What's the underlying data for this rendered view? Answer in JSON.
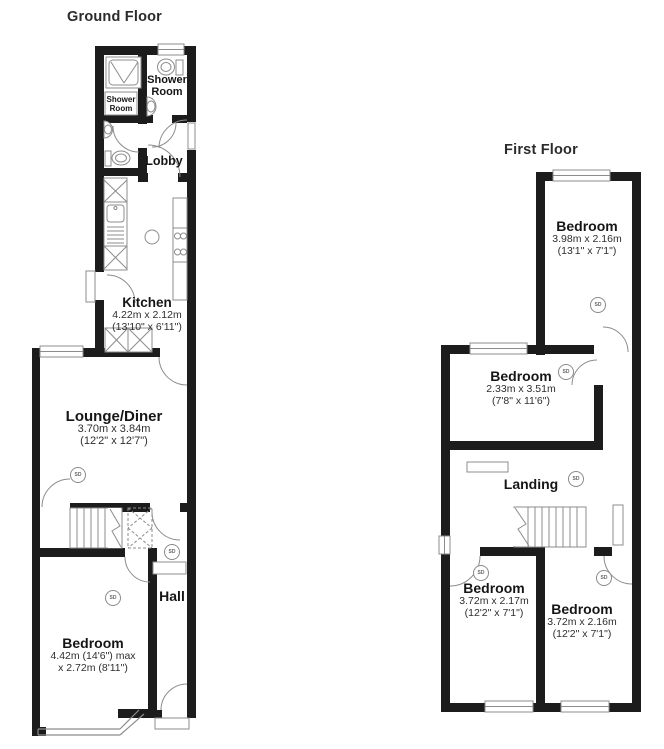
{
  "document_type": "floorplan",
  "sd_label": "SD",
  "colors": {
    "wall": "#1c1c1c",
    "fixture_line": "#8c8c8c",
    "text": "#161616",
    "background": "#ffffff"
  },
  "ground_floor": {
    "title": "Ground Floor",
    "shower_room_rear": {
      "line1": "Shower",
      "line2": "Room"
    },
    "shower_room_small": {
      "line1": "Shower",
      "line2": "Room"
    },
    "lobby": {
      "name": "Lobby"
    },
    "kitchen": {
      "name": "Kitchen",
      "metric": "4.22m x 2.12m",
      "imperial": "(13'10\" x 6'11\")"
    },
    "lounge": {
      "name": "Lounge/Diner",
      "metric": "3.70m x 3.84m",
      "imperial": "(12'2\" x 12'7\")"
    },
    "hall": {
      "name": "Hall"
    },
    "bedroom": {
      "name": "Bedroom",
      "metric": "4.42m (14'6\") max",
      "imperial": "x 2.72m (8'11\")"
    }
  },
  "first_floor": {
    "title": "First Floor",
    "bedroom_rear": {
      "name": "Bedroom",
      "metric": "3.98m x 2.16m",
      "imperial": "(13'1\" x 7'1\")"
    },
    "bedroom_middle": {
      "name": "Bedroom",
      "metric": "2.33m x 3.51m",
      "imperial": "(7'8\" x 11'6\")"
    },
    "landing": {
      "name": "Landing"
    },
    "bedroom_front_left": {
      "name": "Bedroom",
      "metric": "3.72m x 2.17m",
      "imperial": "(12'2\" x 7'1\")"
    },
    "bedroom_front_right": {
      "name": "Bedroom",
      "metric": "3.72m x 2.16m",
      "imperial": "(12'2\" x 7'1\")"
    }
  }
}
